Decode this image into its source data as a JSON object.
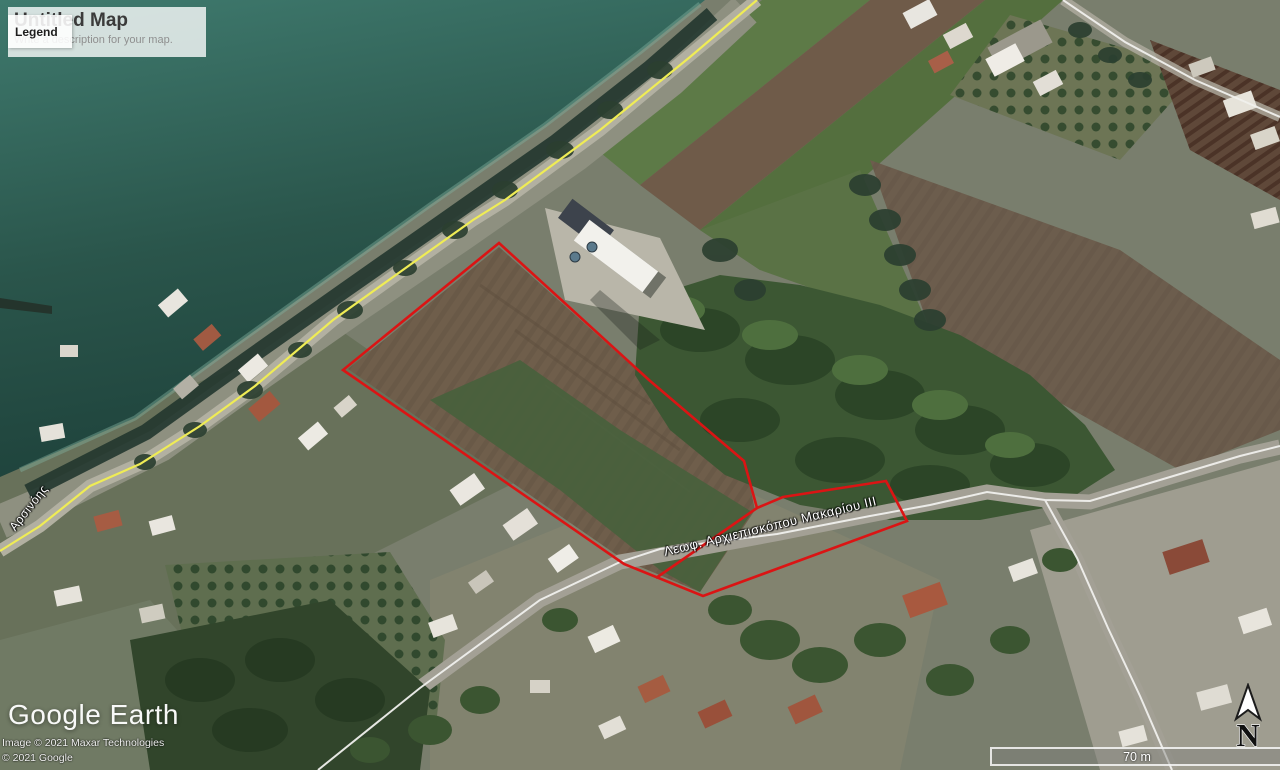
{
  "map_overlay": {
    "title": "Untitled Map",
    "description": "Write a description for your map.",
    "legend_label": "Legend"
  },
  "street_labels": {
    "main_road": "Λεωφ. Αρχιεπισκόπου Μακαρίου III",
    "side_road": "Αρσινόης"
  },
  "attribution": {
    "logo": "Google Earth",
    "imagery_line": "Image © 2021 Maxar Technologies",
    "copyright_line": "© 2021 Google"
  },
  "scale_bar": {
    "label": "70 m"
  },
  "compass": {
    "north_label": "N"
  },
  "colors": {
    "parcel_outline": "#db1414",
    "road_highlight_yellow": "#efec55",
    "road_line_white": "#f0f0ed",
    "sea_deep": "#1e423b",
    "sea_shallow": "#3f7a6e"
  }
}
